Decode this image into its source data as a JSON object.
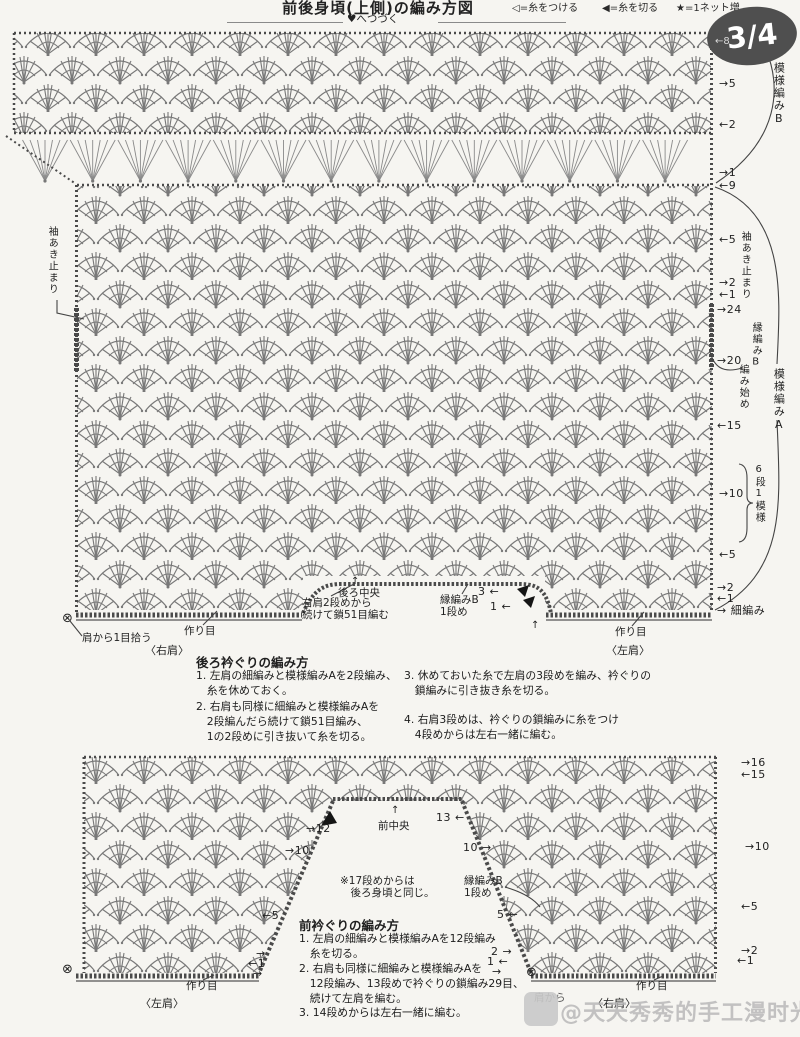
{
  "header": {
    "title": "前後身頃(上側)の編み方図",
    "legend_attach": "◁=糸をつける",
    "legend_cut": "◀=糸を切る",
    "legend_net": "★=1ネット増",
    "continue_note": "♥へつづく",
    "page_badge": "3/4",
    "badge_row": "←8"
  },
  "chart1": {
    "side_labels": {
      "pattern_b": "模様編みB",
      "sleeve_stop_right": "袖あき止まり",
      "edge_b_start_line1": "縁編みB",
      "edge_b_start_line2": "編み始め",
      "pattern_a": "模様編みA",
      "six_row_repeat": "6段1模様",
      "sc_row": "→ 細編み",
      "sleeve_stop_left": "袖あき止まり"
    },
    "row_marks": {
      "b5": "→5",
      "b2": "←2",
      "a1": "→1",
      "a9": "←9",
      "a5": "←5",
      "a2": "→2",
      "a1b": "←1",
      "a24": "→24",
      "a20": "→20",
      "a15": "←15",
      "a10": "→10",
      "a5b": "←5",
      "a2b": "→2",
      "a1c": "←1"
    },
    "bottom": {
      "start_mark": "⊗",
      "pick_up": "肩から1目拾う",
      "cast_on_right": "作り目",
      "right_shoulder": "〈右肩〉",
      "chain_note": "右肩2段めから\n続けて鎖51目編む",
      "back_center": "後ろ中央",
      "up_arrow": "↑",
      "edge_b_label": "縁編みB\n1段め",
      "row3": "3 ←",
      "row1": "1 ←",
      "left_up_arrow": "↑",
      "cast_on_left": "作り目",
      "left_shoulder": "〈左肩〉"
    }
  },
  "instructions_back": {
    "title": "後ろ衿ぐりの編み方",
    "step1": "1. 左肩の細編みと模様編みAを2段編み、\n　糸を休めておく。",
    "step2": "2. 右肩も同様に細編みと模様編みAを\n　2段編んだら続けて鎖51目編み、\n　1の2段めに引き抜いて糸を切る。",
    "step3": "3. 休めておいた糸で左肩の3段めを編み、衿ぐりの\n　鎖編みに引き抜き糸を切る。",
    "step4": "4. 右肩3段めは、衿ぐりの鎖編みに糸をつけ\n　4段めからは左右一緒に編む。"
  },
  "chart2": {
    "row_marks_right": {
      "r16": "→16",
      "r15": "←15",
      "r10": "→10",
      "r5": "←5",
      "r2": "→2",
      "r1": "←1"
    },
    "neck_labels": {
      "m12": "→12",
      "m13": "13 ←",
      "up_arrow": "↑",
      "front_center": "前中央",
      "left10": "→10",
      "right10": "10 →",
      "left5": "←5",
      "right5": "5 ←",
      "left2": "→",
      "left1": "←1",
      "left0": "→",
      "right2": "2 →",
      "right1": "1 ←",
      "right0": "→",
      "note": "※17段めからは\n　後ろ身頃と同じ。",
      "edge_b_label": "縁編みB\n1段め"
    },
    "bottom": {
      "start_mark_left": "⊗",
      "start_mark_right": "⊗",
      "cast_on_left_piece": "作り目",
      "left_shoulder": "〈左肩〉",
      "cast_on_right_piece": "作り目",
      "right_shoulder": "〈右肩〉",
      "pick_up_hidden": "肩から"
    }
  },
  "instructions_front": {
    "title": "前衿ぐりの編み方",
    "step1": "1. 左肩の細編みと模様編みAを12段編み\n　糸を切る。",
    "step2": "2. 右肩も同様に細編みと模様編みAを\n　12段編み、13段めで衿ぐりの鎖編み29目、\n　続けて左肩を編む。",
    "step3": "3. 14段めからは左右一緒に編む。"
  },
  "watermark": {
    "text": "@天天秀秀的手工漫时光"
  }
}
